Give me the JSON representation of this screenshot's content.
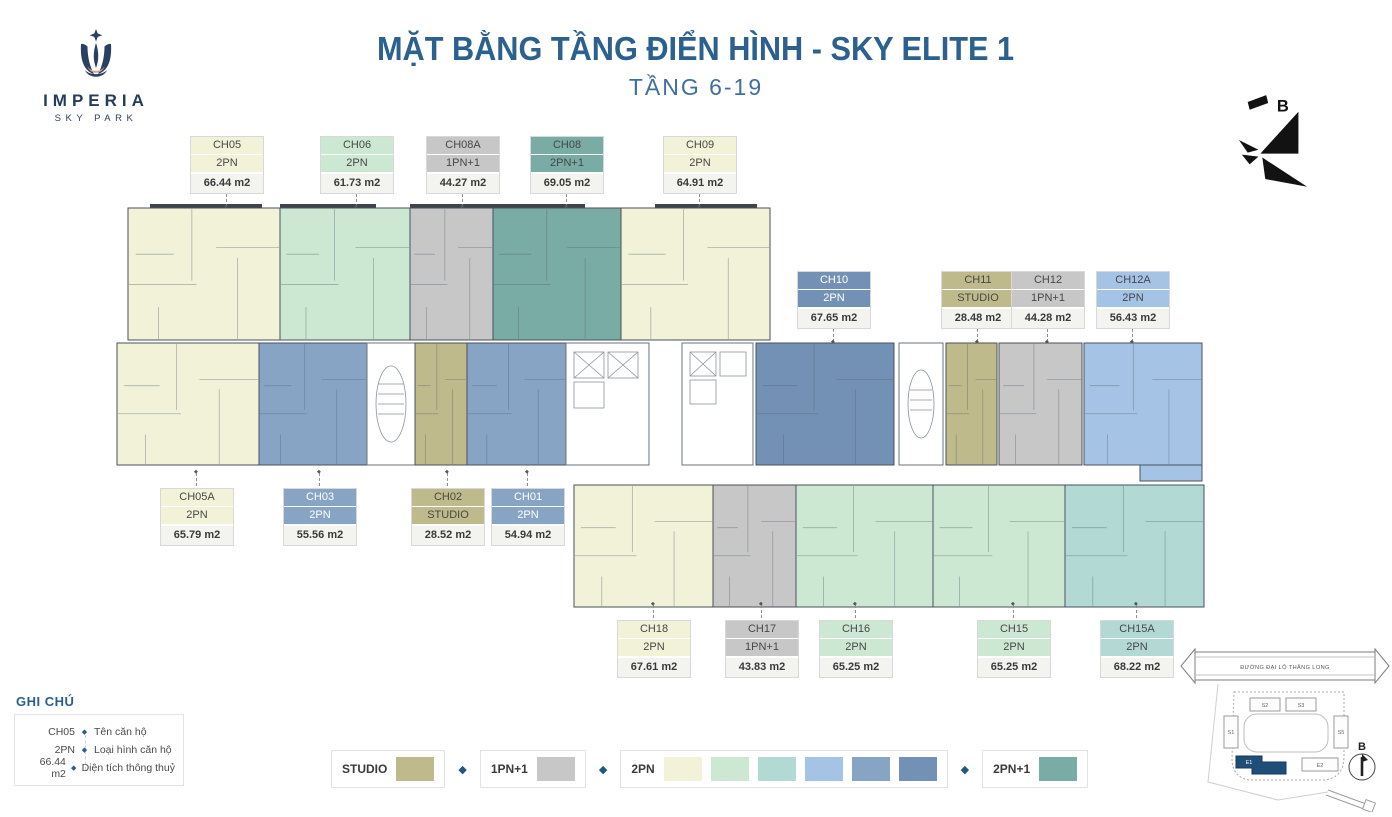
{
  "logo": {
    "name": "IMPERIA",
    "subtitle": "SKY PARK"
  },
  "header": {
    "title": "MẶT BẰNG TẦNG ĐIỂN HÌNH - SKY ELITE 1",
    "subtitle": "TẦNG 6-19"
  },
  "compass": {
    "label": "B"
  },
  "colors": {
    "accent": "#2a5e8e",
    "navy": "#253c5e",
    "cream": "#f1f2d8",
    "mint": "#cde8d2",
    "aqua": "#b2d9d4",
    "lightblue": "#a5c3e5",
    "slate": "#87a4c5",
    "darkslate": "#7391b5",
    "teal": "#79aca4",
    "khaki": "#bfba8b",
    "gray": "#c7c7c7",
    "highlight_building": "#1f4e79"
  },
  "units": [
    {
      "code": "CH05",
      "type": "2PN",
      "area": "66.44 m2",
      "color": "cream",
      "dark_text": true
    },
    {
      "code": "CH06",
      "type": "2PN",
      "area": "61.73 m2",
      "color": "mint",
      "dark_text": true
    },
    {
      "code": "CH08A",
      "type": "1PN+1",
      "area": "44.27 m2",
      "color": "gray",
      "dark_text": true
    },
    {
      "code": "CH08",
      "type": "2PN+1",
      "area": "69.05 m2",
      "color": "teal",
      "dark_text": true
    },
    {
      "code": "CH09",
      "type": "2PN",
      "area": "64.91 m2",
      "color": "cream",
      "dark_text": true
    },
    {
      "code": "CH10",
      "type": "2PN",
      "area": "67.65 m2",
      "color": "darkslate",
      "dark_text": false
    },
    {
      "code": "CH11",
      "type": "STUDIO",
      "area": "28.48 m2",
      "color": "khaki",
      "dark_text": true
    },
    {
      "code": "CH12",
      "type": "1PN+1",
      "area": "44.28 m2",
      "color": "gray",
      "dark_text": true
    },
    {
      "code": "CH12A",
      "type": "2PN",
      "area": "56.43 m2",
      "color": "lightblue",
      "dark_text": true
    },
    {
      "code": "CH05A",
      "type": "2PN",
      "area": "65.79 m2",
      "color": "cream",
      "dark_text": true
    },
    {
      "code": "CH03",
      "type": "2PN",
      "area": "55.56 m2",
      "color": "slate",
      "dark_text": false
    },
    {
      "code": "CH02",
      "type": "STUDIO",
      "area": "28.52 m2",
      "color": "khaki",
      "dark_text": true
    },
    {
      "code": "CH01",
      "type": "2PN",
      "area": "54.94 m2",
      "color": "slate",
      "dark_text": false
    },
    {
      "code": "CH18",
      "type": "2PN",
      "area": "67.61 m2",
      "color": "cream",
      "dark_text": true
    },
    {
      "code": "CH17",
      "type": "1PN+1",
      "area": "43.83 m2",
      "color": "gray",
      "dark_text": true
    },
    {
      "code": "CH16",
      "type": "2PN",
      "area": "65.25 m2",
      "color": "mint",
      "dark_text": true
    },
    {
      "code": "CH15",
      "type": "2PN",
      "area": "65.25 m2",
      "color": "mint",
      "dark_text": true
    },
    {
      "code": "CH15A",
      "type": "2PN",
      "area": "68.22 m2",
      "color": "aqua",
      "dark_text": true
    }
  ],
  "notes_legend": {
    "title": "GHI CHÚ",
    "rows": [
      {
        "value": "CH05",
        "desc": "Tên căn hộ"
      },
      {
        "value": "2PN",
        "desc": "Loại hình căn hộ"
      },
      {
        "value": "66.44 m2",
        "desc": "Diện tích thông thuỷ"
      }
    ]
  },
  "type_legend": [
    {
      "label": "STUDIO",
      "swatches": [
        "khaki"
      ]
    },
    {
      "label": "1PN+1",
      "swatches": [
        "gray"
      ]
    },
    {
      "label": "2PN",
      "swatches": [
        "cream",
        "mint",
        "aqua",
        "lightblue",
        "slate",
        "darkslate"
      ]
    },
    {
      "label": "2PN+1",
      "swatches": [
        "teal"
      ]
    }
  ],
  "site_map": {
    "road_label": "ĐƯỜNG ĐẠI LỘ THĂNG LONG",
    "buildings": [
      "S2",
      "S3",
      "S1",
      "S5",
      "E2"
    ],
    "highlighted_building": "E1",
    "compass_label": "B"
  }
}
